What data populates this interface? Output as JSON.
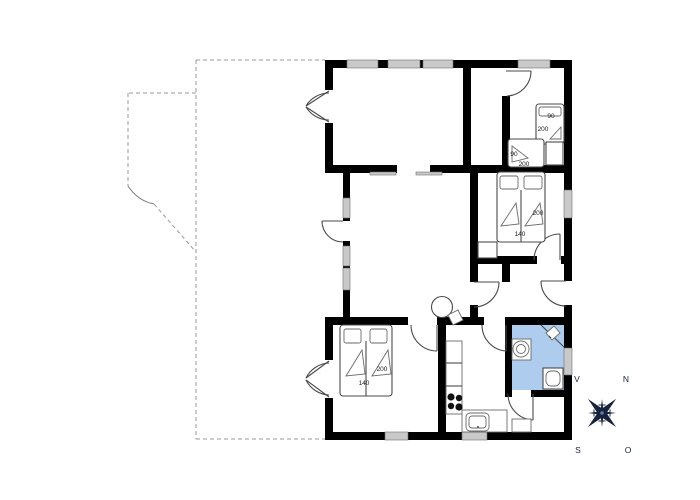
{
  "document": {
    "type": "floor-plan"
  },
  "colors": {
    "wall": "#000000",
    "line": "#4a4a4a",
    "window_fill": "#c9c9c9",
    "bathroom_fill": "#aecdee",
    "compass": "#17233d",
    "compass_center": "#5b79a6",
    "label": "#1a1a1a",
    "dashed": "#9a9a9a"
  },
  "dimension_labels": [
    {
      "text": "90",
      "x": 551,
      "y": 118
    },
    {
      "text": "200",
      "x": 543,
      "y": 131
    },
    {
      "text": "90",
      "x": 514,
      "y": 156
    },
    {
      "text": "200",
      "x": 524,
      "y": 166
    },
    {
      "text": "200",
      "x": 538,
      "y": 215
    },
    {
      "text": "140",
      "x": 520,
      "y": 236
    },
    {
      "text": "200",
      "x": 382,
      "y": 371
    },
    {
      "text": "140",
      "x": 364,
      "y": 385
    }
  ],
  "compass_labels": [
    {
      "text": "V",
      "x": 577,
      "y": 382
    },
    {
      "text": "N",
      "x": 626,
      "y": 382
    },
    {
      "text": "S",
      "x": 578,
      "y": 453
    },
    {
      "text": "O",
      "x": 628,
      "y": 453
    }
  ]
}
